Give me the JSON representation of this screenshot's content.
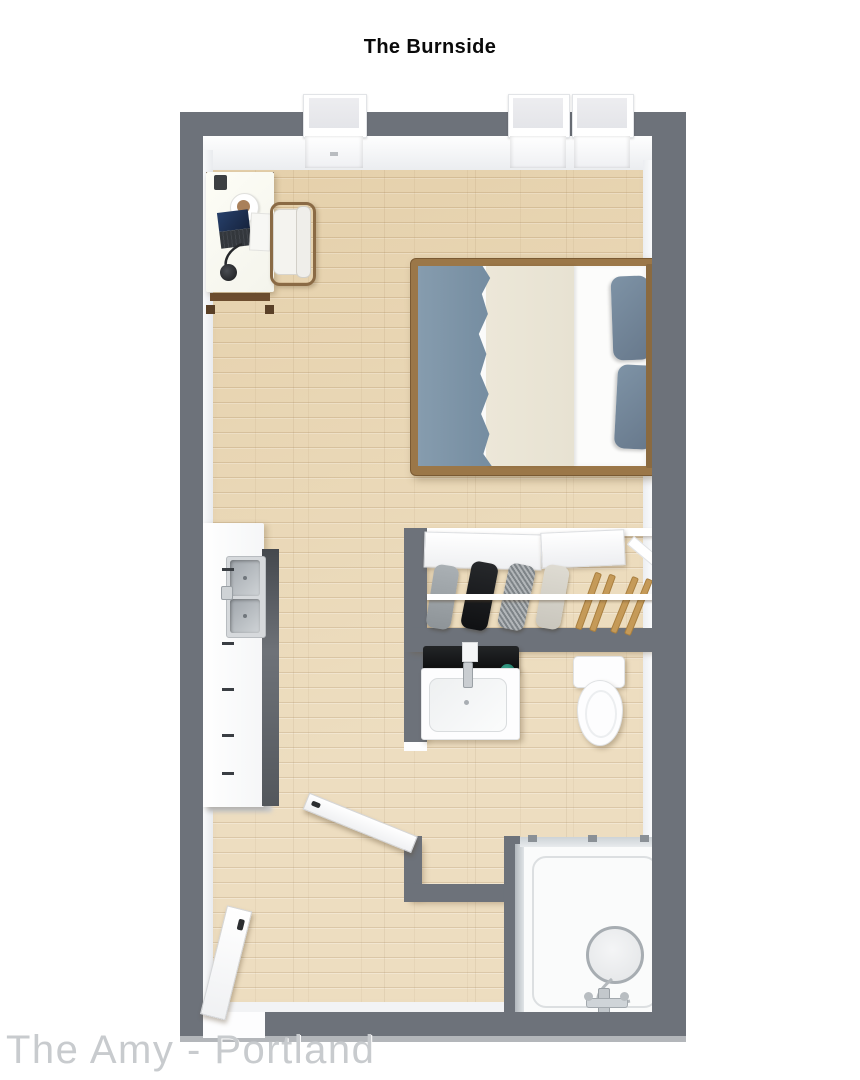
{
  "title": "The Burnside",
  "watermark": "The Amy - Portland",
  "plan": {
    "type": "3d-floor-plan",
    "rooms": [
      "living-sleeping-area",
      "kitchenette",
      "closet",
      "bathroom",
      "shower"
    ],
    "furniture": [
      "desk",
      "desk-chair",
      "laptop",
      "coffee-cup",
      "desk-lamp",
      "pen-holder",
      "bed",
      "blanket",
      "duvet",
      "pillows",
      "kitchen-counter",
      "double-sink",
      "sliding-closet-doors",
      "hanging-clothes",
      "wooden-hangers",
      "towel-shelf",
      "vanity-sink",
      "toilet",
      "shower-enclosure",
      "windows",
      "entry-door",
      "bathroom-door"
    ],
    "colors": {
      "wall": "#6d727a",
      "floor": "#e9d6b2",
      "bed_blanket": "#7e95a8",
      "bed_duvet": "#ebe6d7",
      "bed_frame_wood": "#9b7748",
      "soap": "#23907c"
    }
  }
}
